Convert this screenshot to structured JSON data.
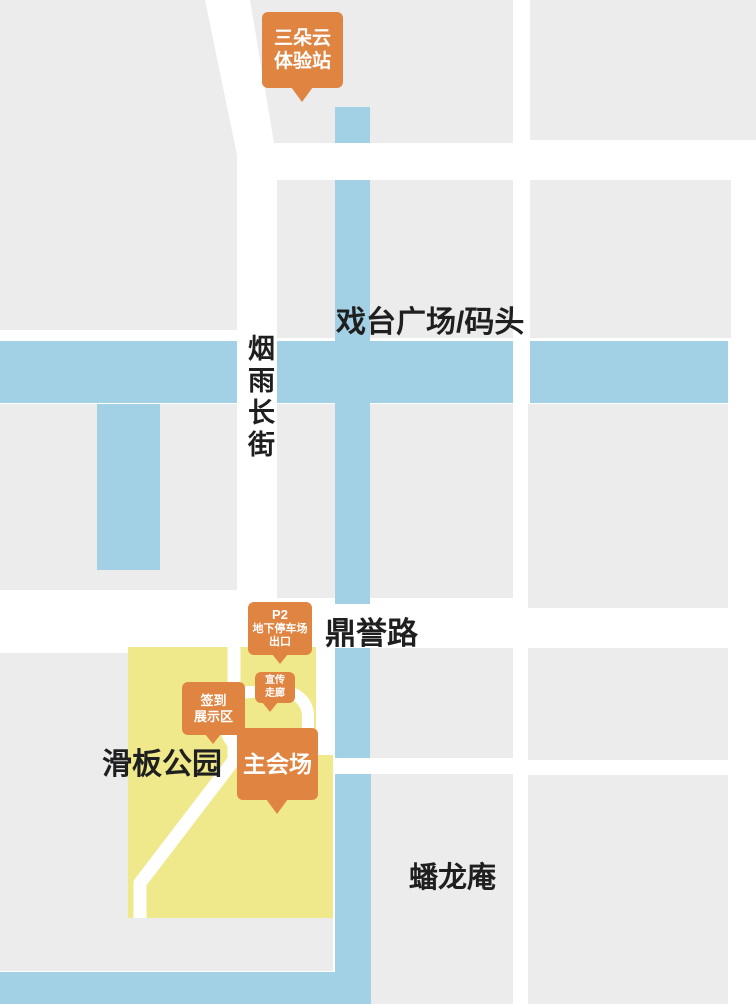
{
  "colors": {
    "gray": "#ececec",
    "blue": "#a2d1e6",
    "yellow": "#f0e98c",
    "orange": "#e08442",
    "ink": "#1f1f1f",
    "street": "#ffffff"
  },
  "labels": {
    "plaza": "戏台广场/码头",
    "street_vertical": "烟雨长街",
    "road": "鼎誉路",
    "park": "滑板公园",
    "temple": "蟠龙庵"
  },
  "markers": {
    "cloud_station": {
      "lines": [
        "三朵云",
        "体验站"
      ]
    },
    "parking_exit": {
      "lines": [
        "P2",
        "地下停车场",
        "出口"
      ]
    },
    "promo_corridor": {
      "lines": [
        "宣传",
        "走廊"
      ]
    },
    "signin_area": {
      "lines": [
        "签到",
        "展示区"
      ]
    },
    "main_venue": {
      "lines": [
        "主会场"
      ]
    }
  }
}
